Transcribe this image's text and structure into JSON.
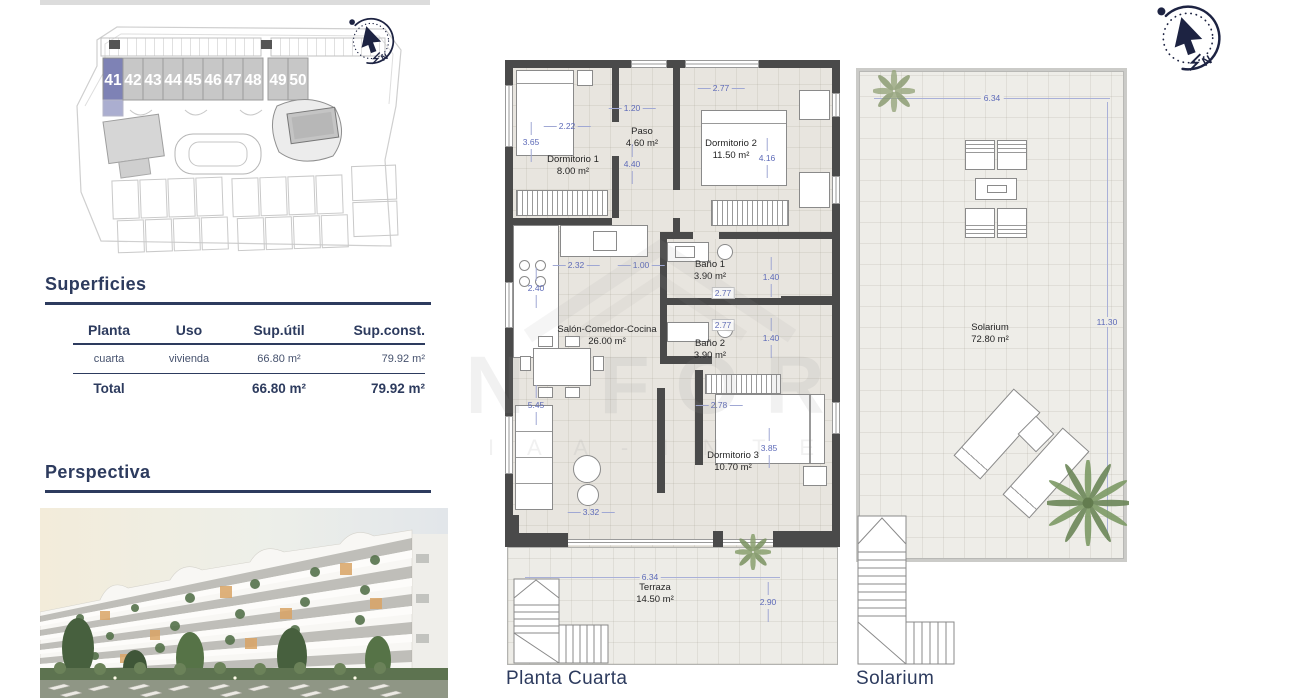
{
  "site_plan": {
    "units": [
      "41",
      "42",
      "43",
      "44",
      "45",
      "46",
      "47",
      "48",
      "49",
      "50"
    ],
    "highlighted_unit": "41",
    "colors": {
      "highlight": "#7e82b5",
      "block": "#c7c7c7",
      "number": "#ffffff"
    }
  },
  "compass": {
    "north_label": "N"
  },
  "superficies": {
    "title": "Superficies",
    "columns": [
      "Planta",
      "Uso",
      "Sup.útil",
      "Sup.const."
    ],
    "rows": [
      {
        "planta": "cuarta",
        "uso": "vivienda",
        "sup_util": "66.80 m²",
        "sup_const": "79.92 m²"
      }
    ],
    "total": {
      "label": "Total",
      "sup_util": "66.80 m²",
      "sup_const": "79.92 m²"
    }
  },
  "perspectiva": {
    "title": "Perspectiva"
  },
  "floor_plan": {
    "label": "Planta Cuarta",
    "rooms": [
      {
        "name": "Dormitorio 1",
        "area": "8.00 m²"
      },
      {
        "name": "Paso",
        "area": "4.60 m²"
      },
      {
        "name": "Dormitorio 2",
        "area": "11.50 m²"
      },
      {
        "name": "Baño 1",
        "area": "3.90 m²"
      },
      {
        "name": "Baño 2",
        "area": "3.90 m²"
      },
      {
        "name": "Salón-Comedor-Cocina",
        "area": "26.00 m²"
      },
      {
        "name": "Dormitorio 3",
        "area": "10.70 m²"
      },
      {
        "name": "Terraza",
        "area": "14.50 m²"
      }
    ],
    "dims": {
      "dorm1_width": "2.22",
      "dorm1_height": "3.65",
      "paso_width": "1.20",
      "paso_height": "4.40",
      "dorm2_width": "2.77",
      "dorm2_height": "4.16",
      "cocina_width": "2.32",
      "entrada_width": "1.00",
      "cocina_height": "2.40",
      "bano1_height": "1.40",
      "bano1_width": "2.77",
      "bano2_width": "2.77",
      "bano2_height": "1.40",
      "salon_height": "5.45",
      "dorm3_width": "2.78",
      "dorm3_height": "3.85",
      "salon_width": "3.32",
      "terraza_width": "6.34",
      "terraza_height": "2.90"
    }
  },
  "solarium_plan": {
    "label": "Solarium",
    "room": {
      "name": "Solarium",
      "area": "72.80 m²"
    },
    "dims": {
      "width": "6.34",
      "height": "11.30"
    }
  },
  "watermark": {
    "line1": "N FOR",
    "line2": "I A A - I N T E"
  },
  "colors": {
    "title_navy": "#2d3b5e",
    "dim_blue": "#5d6ab8",
    "wall": "#4a4a4a",
    "floor": "#e8e5df",
    "terrace_floor": "#edece7"
  }
}
